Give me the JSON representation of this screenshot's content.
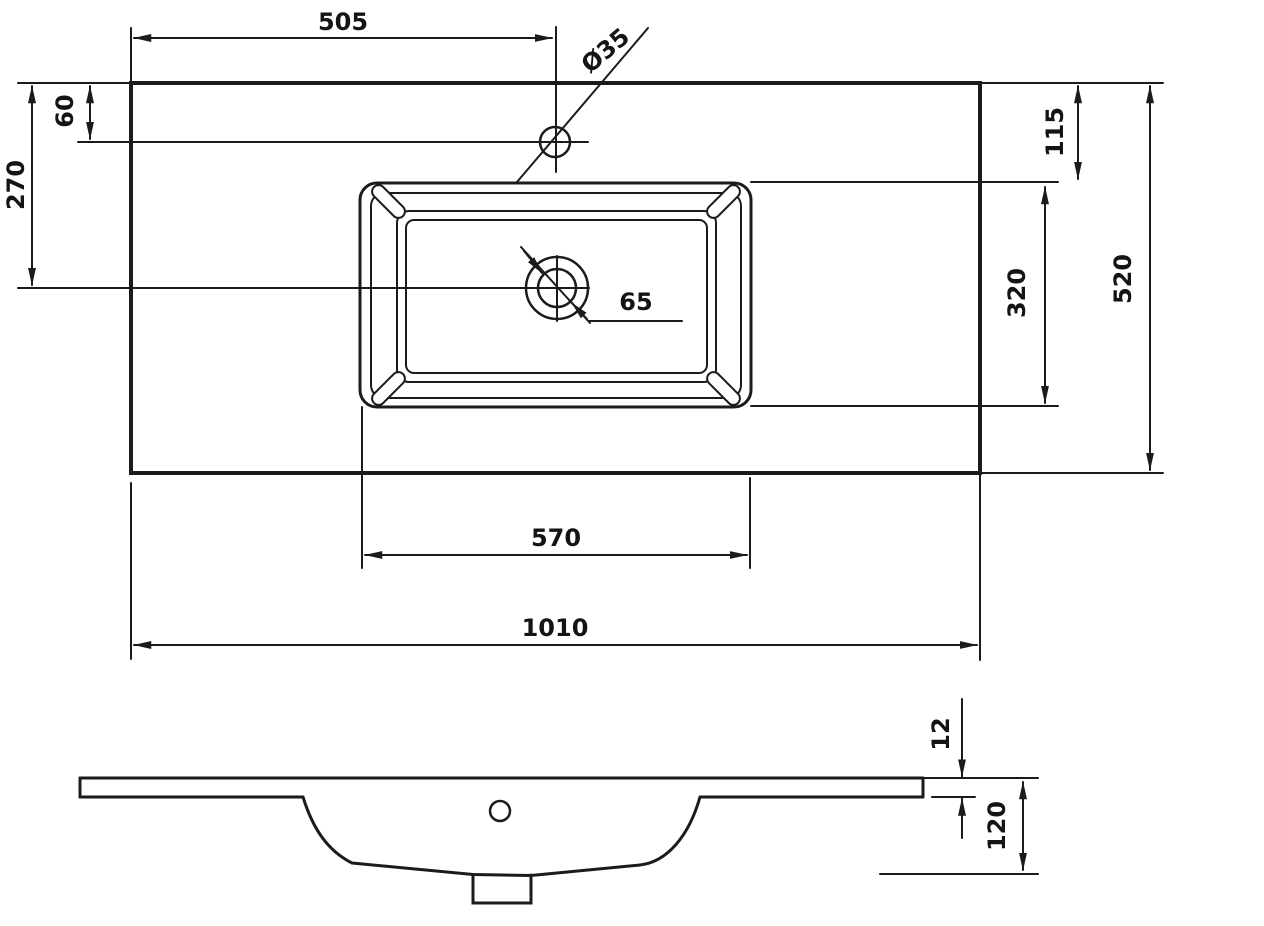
{
  "drawing": {
    "background_color": "#ffffff",
    "line_color": "#1b1b1b",
    "labels": {
      "faucet_offset_from_left": "505",
      "faucet_hole_diameter": "Ø35",
      "faucet_offset_from_back": "60",
      "drain_offset_from_back": "270",
      "basin_offset_from_back": "115",
      "basin_inner_depth": "320",
      "overall_depth": "520",
      "drain_hole_diameter": "65",
      "basin_inner_width": "570",
      "overall_width": "1010",
      "slab_thickness": "12",
      "overall_height": "120"
    }
  }
}
